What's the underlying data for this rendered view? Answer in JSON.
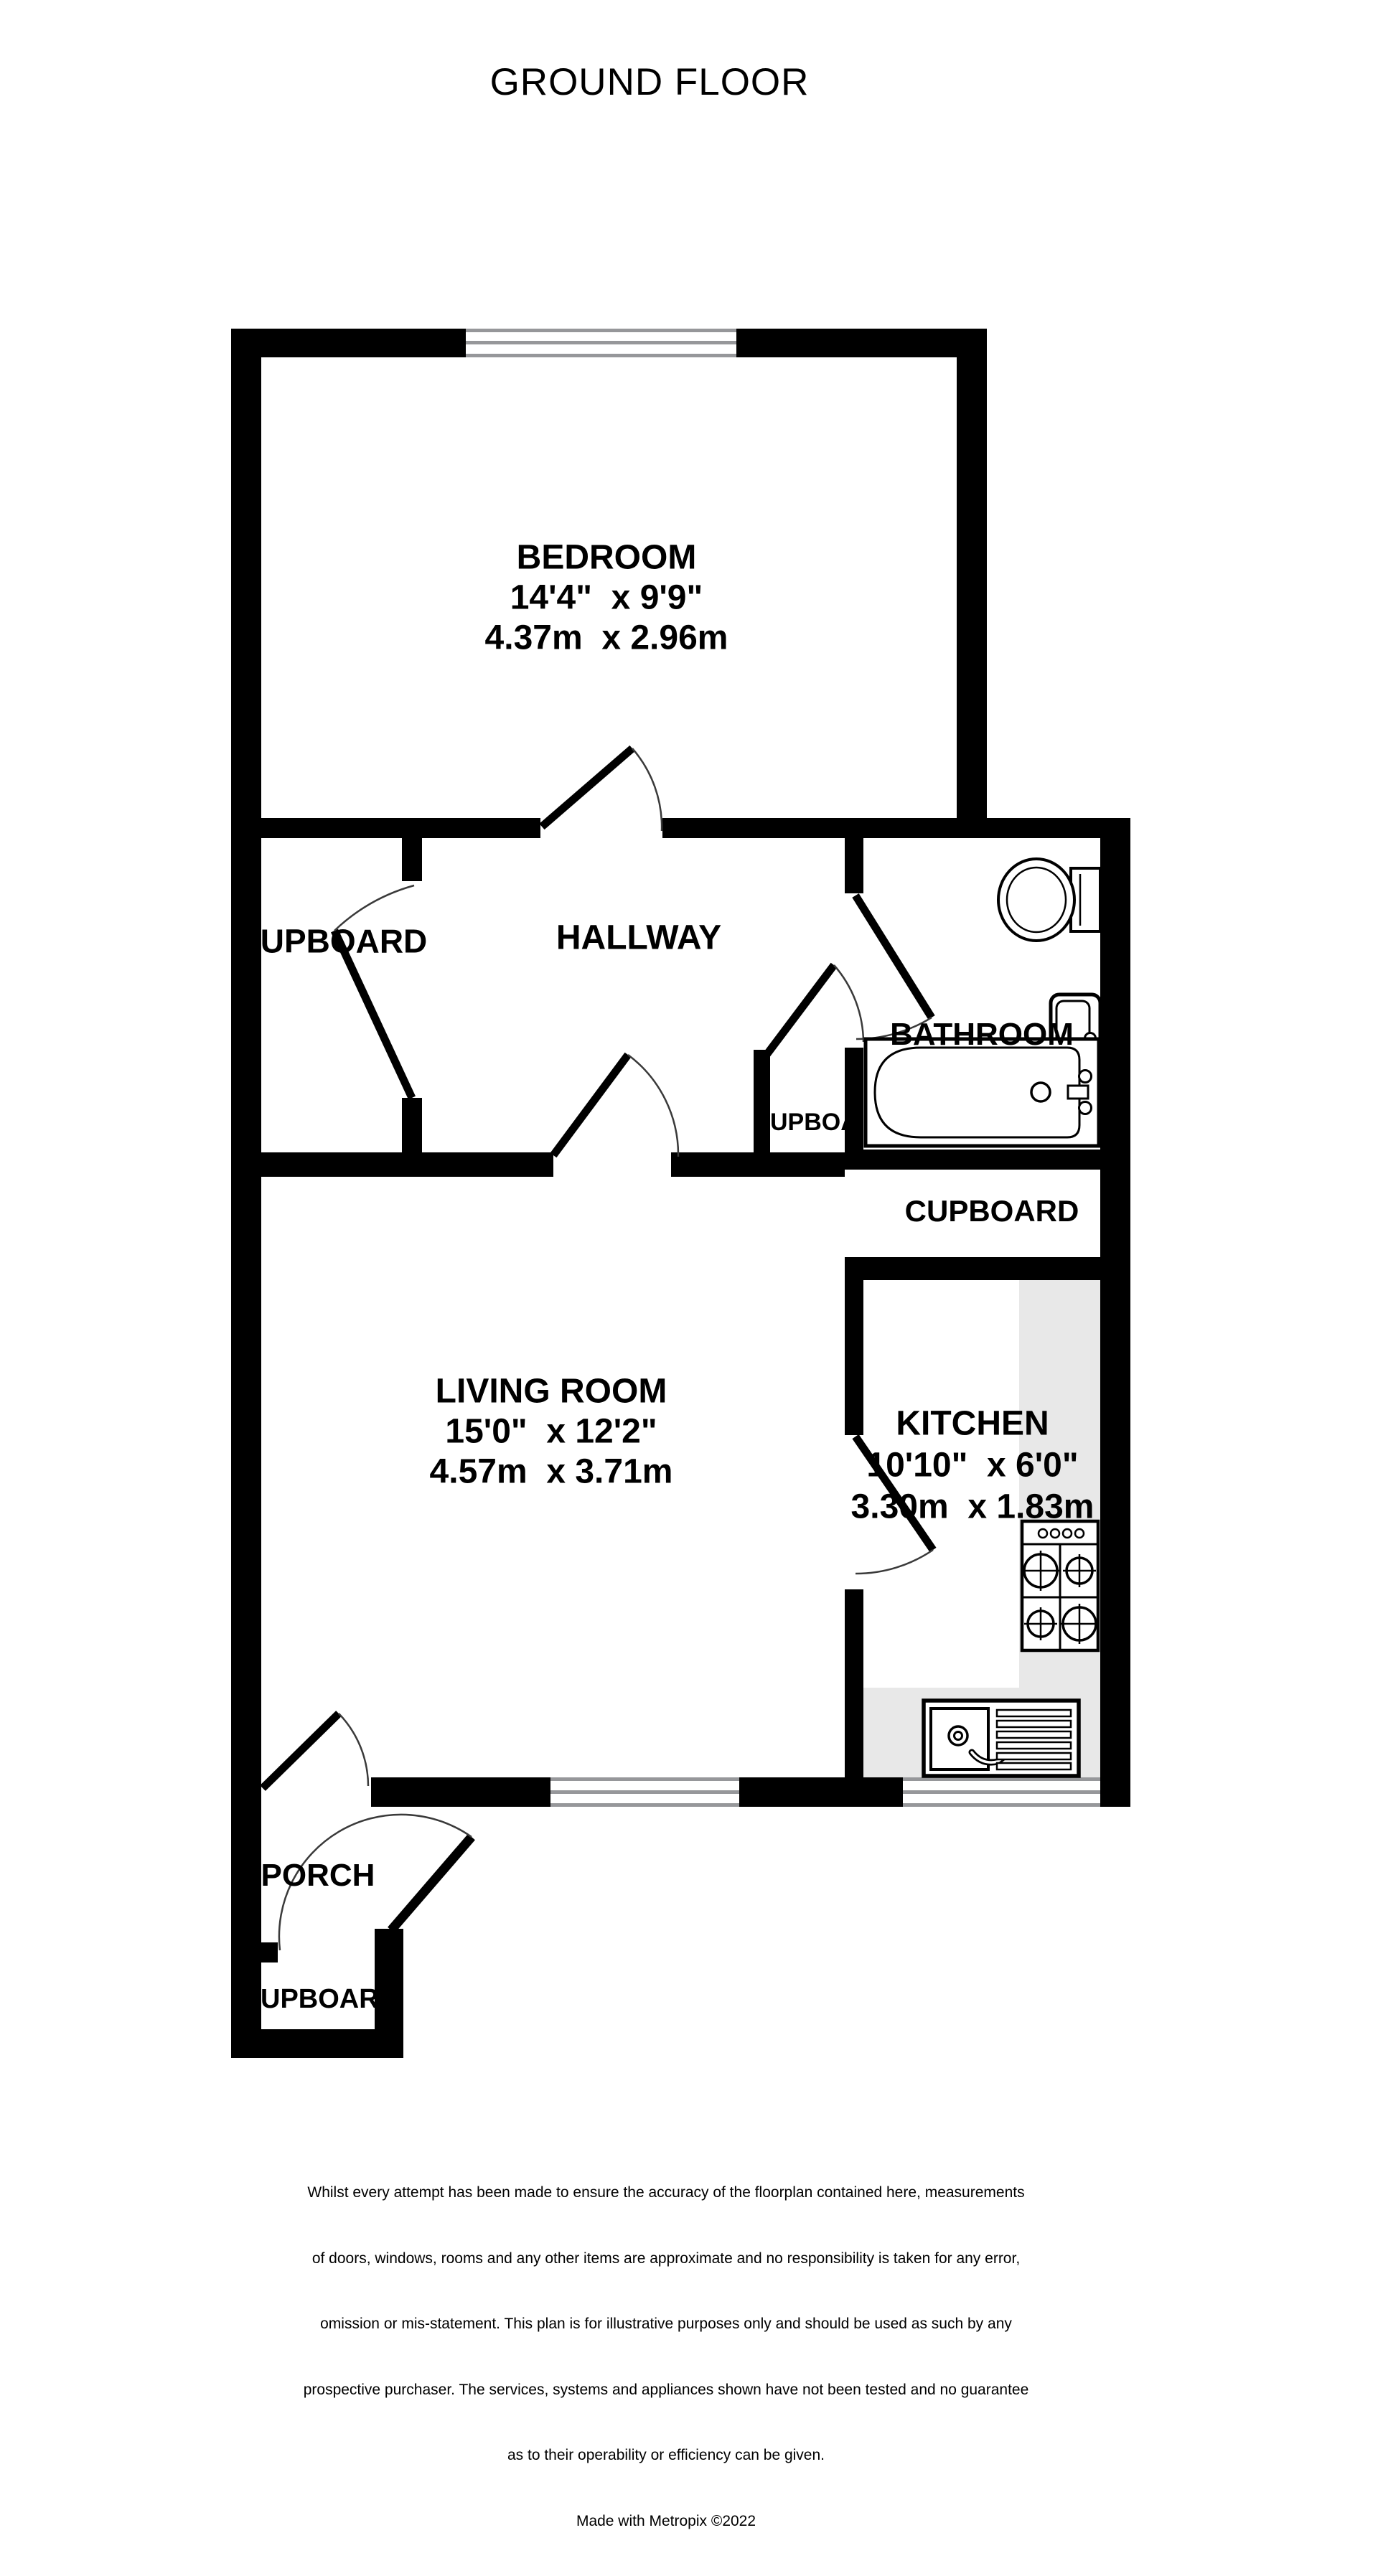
{
  "title": "GROUND FLOOR",
  "rooms": {
    "bedroom": {
      "name": "BEDROOM",
      "imperial": "14'4\"  x 9'9\"",
      "metric": "4.37m  x 2.96m"
    },
    "hallway": {
      "name": "HALLWAY"
    },
    "hall_cupboard": {
      "name": "UPBOARD"
    },
    "small_cupboard": {
      "name": "UPBOARD"
    },
    "bathroom": {
      "name": "BATHROOM"
    },
    "mid_cupboard": {
      "name": "CUPBOARD"
    },
    "living_room": {
      "name": "LIVING ROOM",
      "imperial": "15'0\"  x 12'2\"",
      "metric": "4.57m  x 3.71m"
    },
    "kitchen": {
      "name": "KITCHEN",
      "imperial": "10'10\"  x 6'0\"",
      "metric": "3.30m  x 1.83m"
    },
    "porch": {
      "name": "PORCH"
    },
    "porch_cupboard": {
      "name": "UPBOARD"
    }
  },
  "disclaimer": {
    "lines": [
      "Whilst every attempt has been made to ensure the accuracy of the floorplan contained here, measurements",
      "of doors, windows, rooms and any other items are approximate and no responsibility is taken for any error,",
      "omission or mis-statement. This plan is for illustrative purposes only and should be used as such by any",
      "prospective purchaser. The services, systems and appliances shown have not been tested and no guarantee",
      "as to their operability or efficiency can be given."
    ],
    "credit": "Made with Metropix ©2022"
  },
  "colors": {
    "wall": "#000000",
    "window_line": "#96979a",
    "counter": "#e8e8e8",
    "door_arc": "#3a3a3a"
  }
}
